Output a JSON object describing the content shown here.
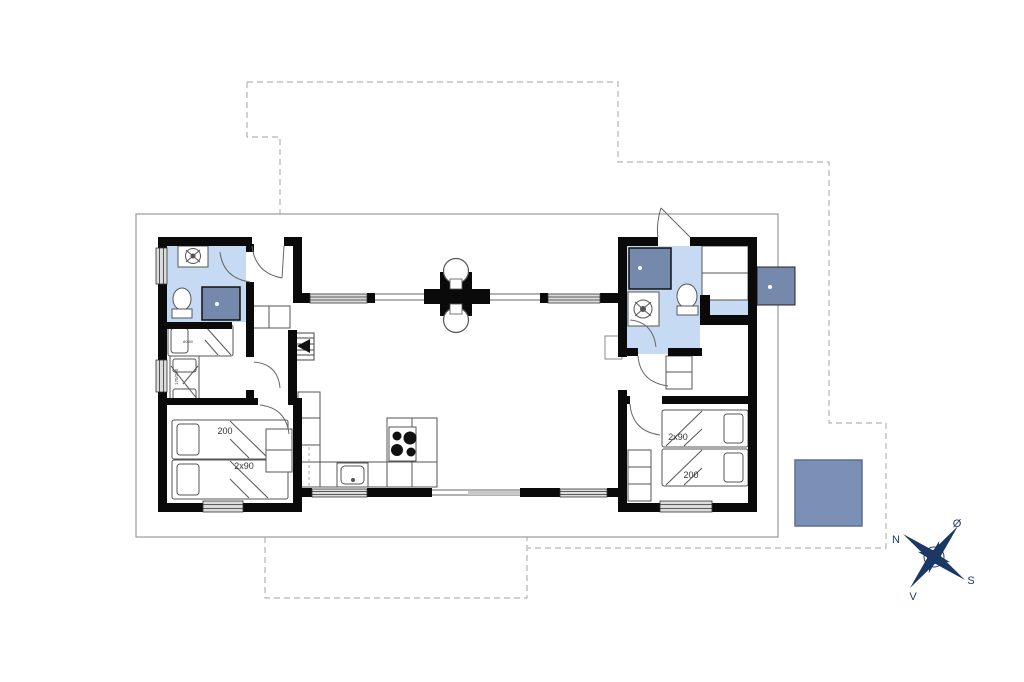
{
  "plan": {
    "type": "holiday-house-floor-plan",
    "rooms": {
      "bedroom_left": {
        "bed_length_label": "200",
        "bed_width_label": "2x90"
      },
      "bedroom_right": {
        "bed_width_label": "2x90",
        "bed_length_label": "200"
      },
      "bunk_room": {
        "bunk_bed_label": "170/200",
        "bunk_small_label": "80/80"
      }
    },
    "compass": {
      "north": "N",
      "east": "Ø",
      "south": "S",
      "west": "V"
    }
  },
  "colors": {
    "bathroom": "#c6daf3",
    "shower": "#7589ad",
    "annex": "#7b90b5",
    "outdoor_shower": "#7589ad",
    "compass": "#1b3764",
    "wall": "#0a0a0a",
    "outline": "#999999",
    "dashed": "#b5b5b5",
    "window_fill": "#dcdcdc"
  },
  "icons": {
    "compass-rose-icon": "four-point-star",
    "washing-machine-icon": "circle-in-square",
    "toilet-icon": "bowl-with-cistern",
    "shower-icon": "filled-square-with-drain-dot",
    "stove-icon": "four-burner-cooktop",
    "sink-icon": "rounded-basin",
    "stairs-icon": "steps-with-arrow",
    "fireplace-icon": "cross-flue-with-circles"
  }
}
